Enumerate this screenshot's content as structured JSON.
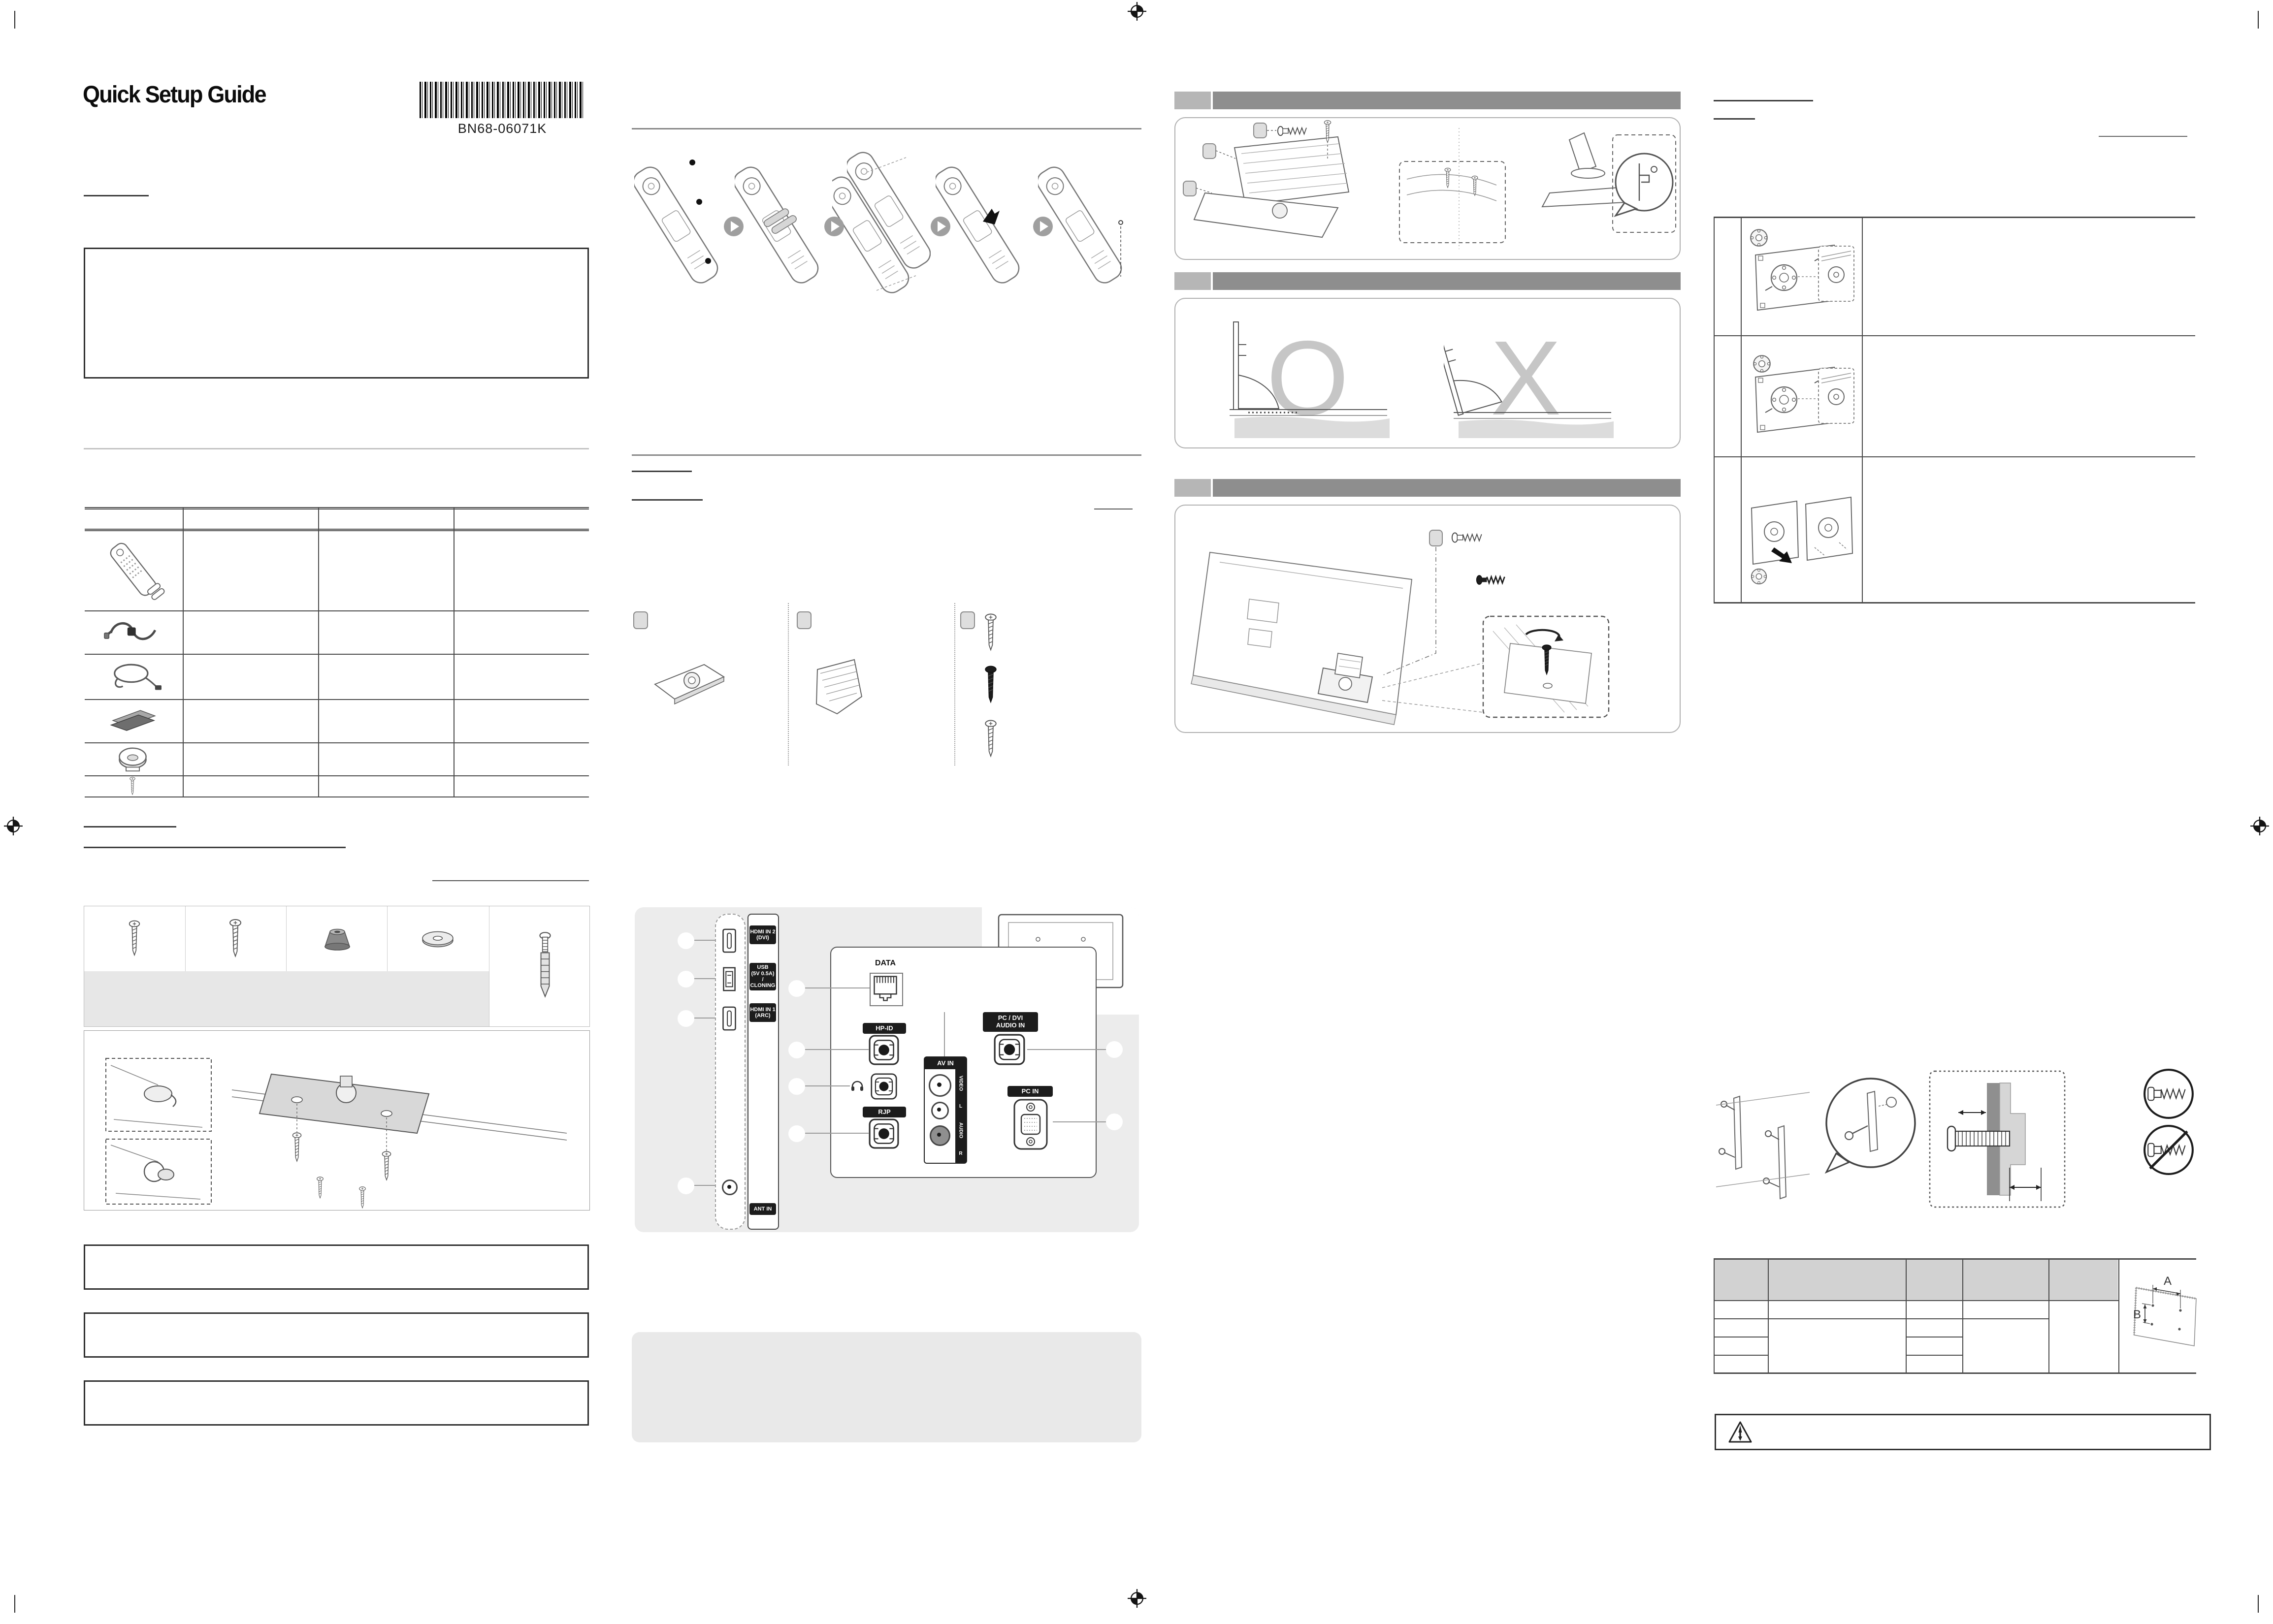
{
  "page": {
    "title": "Quick Setup Guide",
    "barcode_text": "BN68-06071K"
  },
  "colors": {
    "section_bar_dark": "#8e8e8e",
    "section_bar_light": "#b6b6b6",
    "panel_gray": "#ececec",
    "note_gray": "#e9e9e9",
    "table_header_gray": "#d2d2d2",
    "port_label_bg": "#1c1c1c",
    "ghost_letter": "#c6c6c6"
  },
  "side_panel": {
    "hdmi2_line1": "HDMI IN 2",
    "hdmi2_line2": "(DVI)",
    "usb_line1": "USB",
    "usb_line2": "(5V 0.5A)",
    "usb_line3": "/ CLONING",
    "hdmi1_line1": "HDMI IN 1",
    "hdmi1_line2": "(ARC)",
    "ant_label": "ANT IN"
  },
  "rear_panel": {
    "data_label": "DATA",
    "hpid_label": "HP-ID",
    "rjp_label": "RJP",
    "pcdvi_line1": "PC / DVI",
    "pcdvi_line2": "AUDIO IN",
    "avin_label": "AV IN",
    "video_label": "VIDEO",
    "audio_label": "AUDIO",
    "audio_left": "L",
    "audio_right": "R",
    "pcin_label": "PC IN"
  },
  "stand_section": {
    "correct_mark": "O",
    "incorrect_mark": "X"
  },
  "wall_mount": {
    "dim_a": "A",
    "dim_b": "B"
  },
  "icons": {
    "headphone": "headphone-icon",
    "warning": "warning-triangle-icon",
    "registration_mark": "registration-mark-icon",
    "step_arrow": "arrow-right-circle-icon",
    "barcode": "barcode-icon"
  }
}
